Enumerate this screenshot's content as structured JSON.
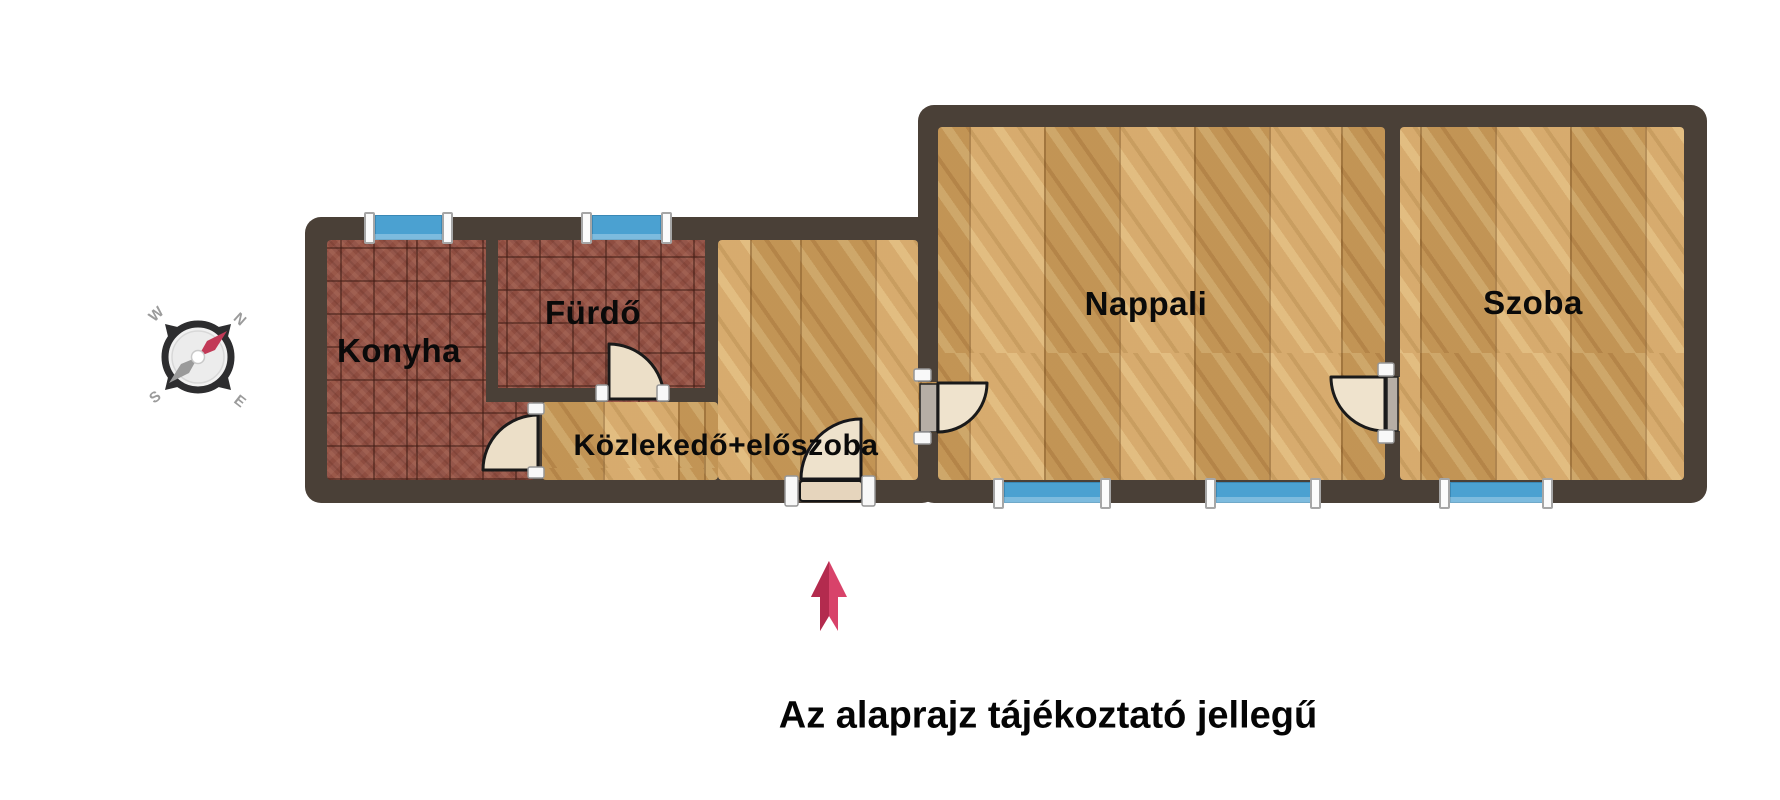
{
  "page": {
    "background": "#ffffff",
    "disclaimer": "Az alaprajz tájékoztató jellegű"
  },
  "floorplan": {
    "rooms": [
      {
        "id": "konyha",
        "label": "Konyha",
        "floor": "red-tile"
      },
      {
        "id": "furdo",
        "label": "Fürdő",
        "floor": "red-tile"
      },
      {
        "id": "kozlekedo",
        "label": "Közlekedő+előszoba",
        "floor": "wood-parquet"
      },
      {
        "id": "nappali",
        "label": "Nappali",
        "floor": "wood-parquet"
      },
      {
        "id": "szoba",
        "label": "Szoba",
        "floor": "wood-parquet"
      }
    ],
    "windows": [
      {
        "id": "window-konyha",
        "wall": "top",
        "room": "Konyha"
      },
      {
        "id": "window-furdo",
        "wall": "top",
        "room": "Fürdő"
      },
      {
        "id": "window-nappali-1",
        "wall": "bottom",
        "room": "Nappali"
      },
      {
        "id": "window-nappali-2",
        "wall": "bottom",
        "room": "Nappali"
      },
      {
        "id": "window-szoba",
        "wall": "bottom",
        "room": "Szoba"
      }
    ],
    "doors": [
      {
        "id": "door-konyha",
        "between": "Közlekedő+előszoba / Konyha"
      },
      {
        "id": "door-furdo",
        "between": "Közlekedő+előszoba / Fürdő"
      },
      {
        "id": "door-entrance",
        "between": "outside / Közlekedő+előszoba"
      },
      {
        "id": "door-hall-nappali",
        "between": "Közlekedő+előszoba / Nappali"
      },
      {
        "id": "door-nappali-szoba",
        "between": "Nappali / Szoba"
      }
    ],
    "colors": {
      "wall": "#4a4037",
      "tile_floor": "#95564a",
      "wood_floor": "#cfa05e",
      "window_blue": "#4ba1d1",
      "door_leaf": "#ecdfc8",
      "arrow_red": "#d8436a",
      "arrow_red_dark": "#b32b4e",
      "compass_ring": "#2d2d2f",
      "needle_red": "#c23a57",
      "needle_gray": "#9a9a9a"
    }
  },
  "compass": {
    "w": "W",
    "n": "N",
    "s": "S",
    "e": "E"
  }
}
